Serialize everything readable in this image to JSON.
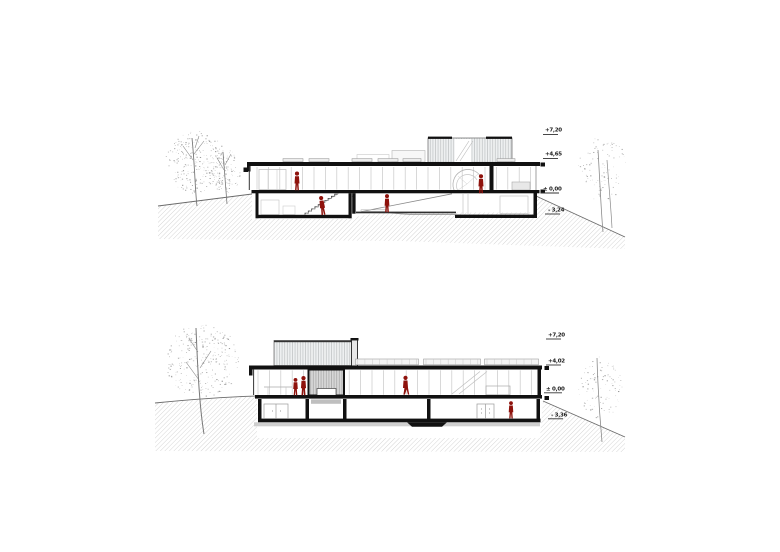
{
  "drawing": {
    "type": "architectural-building-sections",
    "figure_color": "#8e120c",
    "line_color": "#1a1a1a",
    "hatch_color": "#c4c4c4",
    "sections": [
      {
        "name": "upper-section",
        "levels": [
          "+7,20",
          "+4,65",
          "± 0,00",
          "- 3,24"
        ]
      },
      {
        "name": "lower-section",
        "levels": [
          "+7,20",
          "+4,02",
          "± 0,00",
          "- 3,36"
        ]
      }
    ]
  }
}
